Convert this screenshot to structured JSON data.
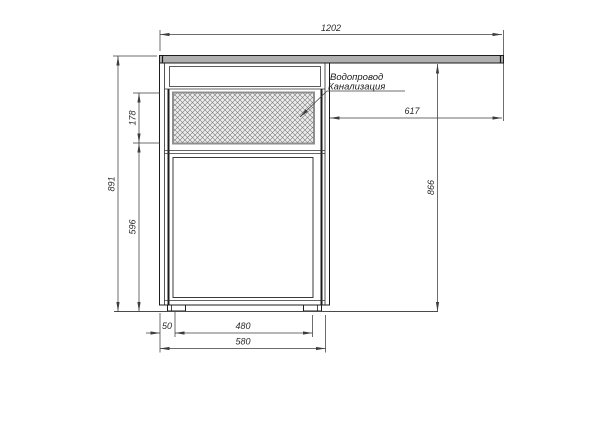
{
  "annotation": {
    "line1": "Водопровод",
    "line2": "Канализация"
  },
  "dimensions": {
    "top_width": "1202",
    "total_height": "891",
    "hatch_height": "178",
    "lower_height": "596",
    "right_height": "866",
    "top_right_width": "617",
    "foot_offset": "50",
    "feet_span": "480",
    "cabinet_width": "580"
  },
  "colors": {
    "object_line": "#1c1c1c",
    "dimension_line": "#3d3d3d",
    "countertop_fill": "#b0b0b0",
    "hatch_line": "#7a7a7a",
    "hatch_background": "#ececec"
  }
}
